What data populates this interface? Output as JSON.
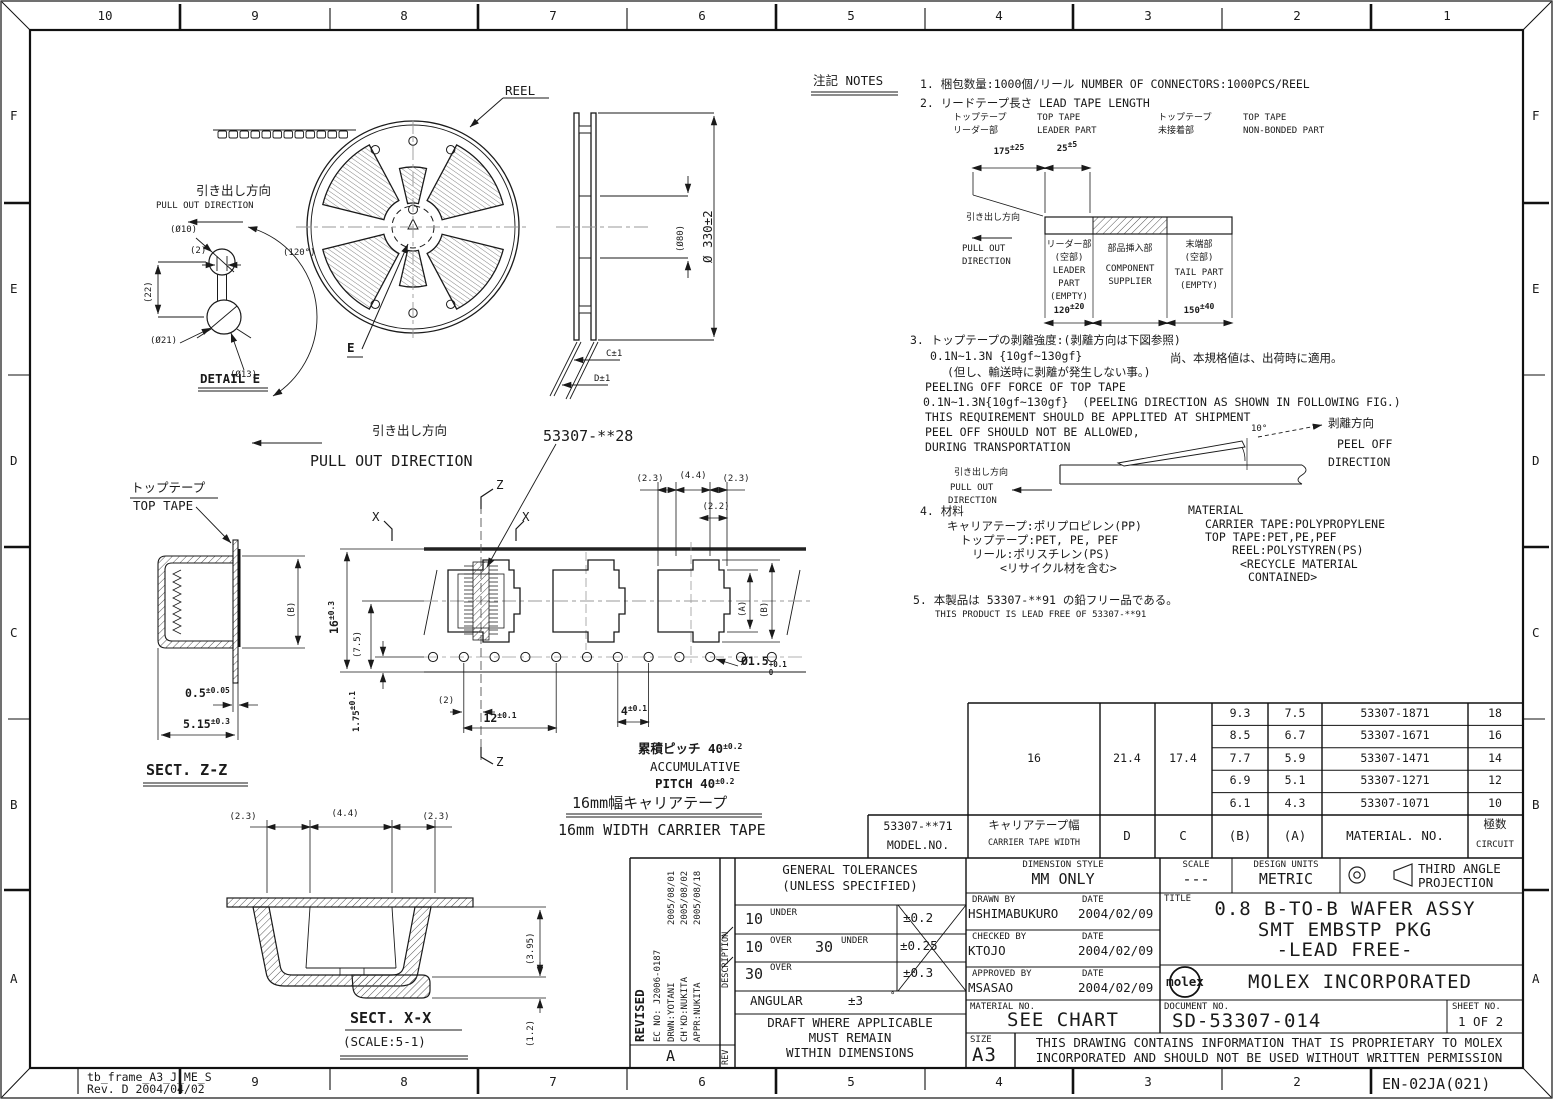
{
  "frame": {
    "top": [
      "10",
      "9",
      "8",
      "7",
      "6",
      "5",
      "4",
      "3",
      "2",
      "1"
    ],
    "bottom": [
      "9",
      "8",
      "7",
      "6",
      "5",
      "4",
      "3",
      "2"
    ],
    "rows": [
      "F",
      "E",
      "D",
      "C",
      "B",
      "A"
    ],
    "stamp1": "tb_frame_A3_J_ME_S",
    "stamp2": "Rev. D 2004/04/02",
    "code": "EN-02JA(021)"
  },
  "labels": {
    "pull_jp": "引き出し方向",
    "pull_en": "PULL OUT DIRECTION",
    "pull_out": "PULL OUT",
    "direction": "DIRECTION"
  },
  "reel": {
    "reel": "REEL",
    "e": "E",
    "detail": "DETAIL E",
    "d10": "(Ø10)",
    "d2": "(2)",
    "d22": "(22)",
    "d21": "(Ø21)",
    "d13": "(Ø13)",
    "d120": "(120°)",
    "d330": "Ø 330±2",
    "d80": "(Ø80)",
    "dc": "C±1",
    "dd": "D±1"
  },
  "tape": {
    "part": "53307-**28",
    "x": "X",
    "z": "Z",
    "d23": "(2.3)",
    "d44": "(4.4)",
    "d23b": "(2.3)",
    "d22": "(2.2)",
    "da": "(A)",
    "db": "(B)",
    "d2": "(2)",
    "d16": "16",
    "d16t": "±0.3",
    "d75": "(7.5)",
    "d175": "1.75",
    "d175t": "±0.1",
    "d12": "12",
    "d12t": "±0.1",
    "d4": "4",
    "d4t": "±0.1",
    "dh": "Ø1.5",
    "dht": "+0.1",
    "dhb": "0",
    "accjp": "累積ピッチ 40",
    "accjpt": "±0.2",
    "acc1": "ACCUMULATIVE",
    "acc2": "PITCH 40",
    "acc2t": "±0.2",
    "wjp": "16mm幅キャリアテープ",
    "wen": "16mm WIDTH CARRIER TAPE"
  },
  "zz": {
    "tjp": "トップテープ",
    "ten": "TOP TAPE",
    "b": "(B)",
    "d05": "0.5",
    "d05t": "±0.05",
    "d515": "5.15",
    "d515t": "±0.3",
    "title": "SECT. Z-Z"
  },
  "xx": {
    "d23": "(2.3)",
    "d44": "(4.4)",
    "d23b": "(2.3)",
    "d395": "(3.95)",
    "d12": "(1.2)",
    "title": "SECT. X-X",
    "scale": "(SCALE:5-1)"
  },
  "notes": {
    "title": "注記 NOTES",
    "n1": "1. 梱包数量:1000個/リール NUMBER OF CONNECTORS:1000PCS/REEL",
    "n2": "2. リードテープ長さ LEAD TAPE LENGTH",
    "tt_jp": "トップテープ",
    "ld_jp": "リーダー部",
    "tt_en": "TOP TAPE",
    "ld_en": "LEADER PART",
    "tt_jp2": "トップテープ",
    "nb_jp": "未接着部",
    "tt_en2": "TOP TAPE",
    "nb_en": "NON-BONDED PART",
    "d175": "175",
    "d175t": "±25",
    "d25": "25",
    "d25t": "±5",
    "c1": [
      "リーダー部",
      "(空部)",
      "LEADER",
      "PART",
      "(EMPTY)"
    ],
    "c1d": "120",
    "c1dt": "±20",
    "c2": [
      "部品挿入部",
      "COMPONENT",
      "SUPPLIER"
    ],
    "c3": [
      "末端部",
      "(空部)",
      "TAIL PART",
      "(EMPTY)"
    ],
    "c3d": "150",
    "c3dt": "±40",
    "n3a": "3. トップテープの剥離強度:(剥離方向は下図参照)",
    "n3b": "0.1N~1.3N {10gf~130gf}",
    "n3c": "尚、本規格値は、出荷時に適用。",
    "n3d": "(但し、輸送時に剥離が発生しない事。)",
    "n3e": "PEELING OFF FORCE OF TOP TAPE",
    "n3f": "0.1N~1.3N{10gf~130gf}  (PEELING DIRECTION AS SHOWN IN FOLLOWING FIG.)",
    "n3g": "THIS REQUIREMENT SHOULD BE APPLITED AT SHIPMENT",
    "n3h": "PEEL OFF SHOULD NOT BE ALLOWED,",
    "n3i": "DURING TRANSPORTATION",
    "deg": "10°",
    "peel_jp": "剥離方向",
    "peel1": "PEEL OFF",
    "peel2": "DIRECTION",
    "n4": "4. 材料",
    "mat": "MATERIAL",
    "m1": "キャリアテープ:ポリプロピレン(PP)",
    "m2": "トップテープ:PET, PE, PEF",
    "m3": "リール:ポリスチレン(PS)",
    "m4": "<リサイクル材を含む>",
    "e1": "CARRIER TAPE:POLYPROPYLENE",
    "e2": "TOP TAPE:PET,PE,PEF",
    "e3": "REEL:POLYSTYREN(PS)",
    "e4": "<RECYCLE MATERIAL",
    "e5": "CONTAINED>",
    "n5a": "5. 本製品は 53307-**91 の鉛フリー品である。",
    "n5b": "THIS PRODUCT IS LEAD FREE OF 53307-**91"
  },
  "table": {
    "model": "53307-**71",
    "model2": "MODEL.NO.",
    "w_jp": "キャリアテープ幅",
    "w_en": "CARRIER TAPE WIDTH",
    "hD": "D",
    "hC": "C",
    "hB": "(B)",
    "hA": "(A)",
    "hM": "MATERIAL. NO.",
    "hc_jp": "極数",
    "hc_en": "CIRCUIT",
    "w": "16",
    "d": "21.4",
    "c": "17.4",
    "rows": [
      {
        "b": "9.3",
        "a": "7.5",
        "m": "53307-1871",
        "n": "18"
      },
      {
        "b": "8.5",
        "a": "6.7",
        "m": "53307-1671",
        "n": "16"
      },
      {
        "b": "7.7",
        "a": "5.9",
        "m": "53307-1471",
        "n": "14"
      },
      {
        "b": "6.9",
        "a": "5.1",
        "m": "53307-1271",
        "n": "12"
      },
      {
        "b": "6.1",
        "a": "4.3",
        "m": "53307-1071",
        "n": "10"
      }
    ]
  },
  "tb": {
    "rev": {
      "revised": "REVISED",
      "ec": "EC NO: J2006-0187",
      "drwn": "DRWN:YOTANI",
      "chkd": "CH'KD:NUKITA",
      "appr": "APPR:NUKITA",
      "dates": [
        "2005/08/01",
        "2005/08/02",
        "2005/08/18"
      ],
      "description": "DESCRIPTION",
      "rev": "REV",
      "rev_letter": "A"
    },
    "tol": {
      "title1": "GENERAL TOLERANCES",
      "title2": "(UNLESS SPECIFIED)",
      "r1n": "10",
      "r1t": "UNDER",
      "r1v": "±0.2",
      "r2n1": "10",
      "r2t1": "OVER",
      "r2n2": "30",
      "r2t2": "UNDER",
      "r2v": "±0.25",
      "r3n": "30",
      "r3t": "OVER",
      "r3v": "±0.3",
      "ang": "ANGULAR",
      "angv": "±3",
      "angu": "°",
      "draft1": "DRAFT WHERE APPLICABLE",
      "draft2": "MUST REMAIN",
      "draft3": "WITHIN DIMENSIONS"
    },
    "info": {
      "dim_style_label": "DIMENSION STYLE",
      "dim_style": "MM ONLY",
      "drawn_label": "DRAWN BY",
      "date_label": "DATE",
      "drawn": "HSHIMABUKURO",
      "drawn_date": "2004/02/09",
      "checked_label": "CHECKED BY",
      "date_label2": "DATE",
      "checked": "KTOJO",
      "checked_date": "2004/02/09",
      "approved_label": "APPROVED BY",
      "date_label3": "DATE",
      "approved": "MSASAO",
      "approved_date": "2004/02/09",
      "material_label": "MATERIAL NO.",
      "material": "SEE CHART",
      "size_label": "SIZE",
      "size": "A3"
    },
    "right": {
      "scale_label": "SCALE",
      "scale": "---",
      "units_label": "DESIGN UNITS",
      "units": "METRIC",
      "proj1": "THIRD ANGLE",
      "proj2": "PROJECTION",
      "title_label": "TITLE",
      "title1": "0.8 B-TO-B WAFER ASSY",
      "title2": "SMT EMBSTP PKG",
      "title3": "-LEAD FREE-",
      "logo": "molex",
      "company": "MOLEX INCORPORATED",
      "doc_label": "DOCUMENT NO.",
      "doc": "SD-53307-014",
      "sheet_label": "SHEET NO.",
      "sheet": "1 OF 2",
      "prop1": "THIS DRAWING CONTAINS INFORMATION THAT IS PROPRIETARY TO MOLEX",
      "prop2": "INCORPORATED AND SHOULD NOT BE USED WITHOUT WRITTEN PERMISSION"
    }
  }
}
